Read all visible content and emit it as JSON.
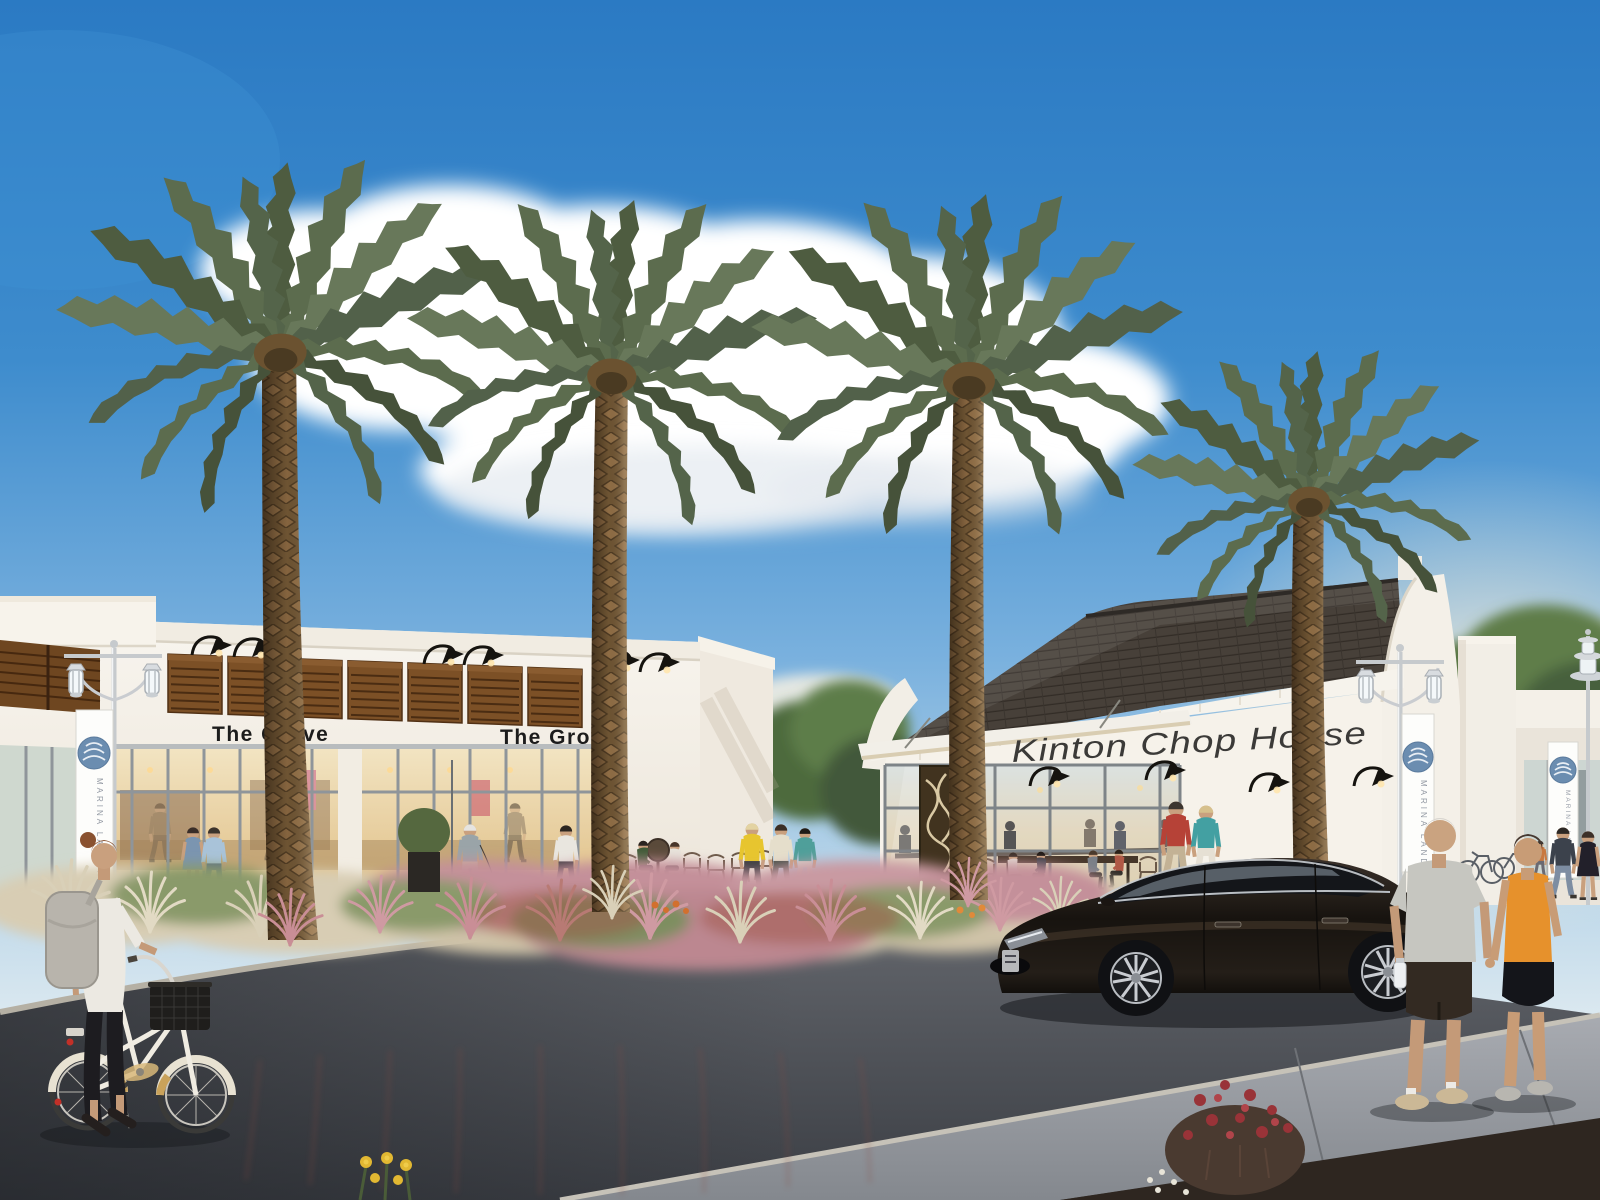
{
  "signs": {
    "grove_left": "The Grove",
    "grove_right": "The Grove",
    "kinton": "Kinton Chop House",
    "banner": "MARINA LANDINGS"
  },
  "palette": {
    "sky_top": "#2b7ac3",
    "sky_horizon": "#e8eff2",
    "cloud": "#ffffff",
    "building_wall": "#f6f2ea",
    "awning_wood": "#7c5026",
    "roof_shingle": "#474039",
    "sign_text": "#1c1c1c",
    "kinton_text": "#3b3a38",
    "banner_logo_blue": "#6b8db0",
    "palm_frond": "#5c6c4e",
    "palm_trunk": "#8f6d45",
    "grass_pink": "#c98e96",
    "grass_plume": "#d9d0b8",
    "road_asphalt": "#4b4e54",
    "sidewalk": "#9ea2a8",
    "mulch": "#2e2620",
    "car_body": "#1d1813",
    "flower_red": "#993338",
    "flower_yellow": "#e2b832",
    "tank_orange": "#e6912c",
    "tee_gray": "#c6c6c0"
  }
}
